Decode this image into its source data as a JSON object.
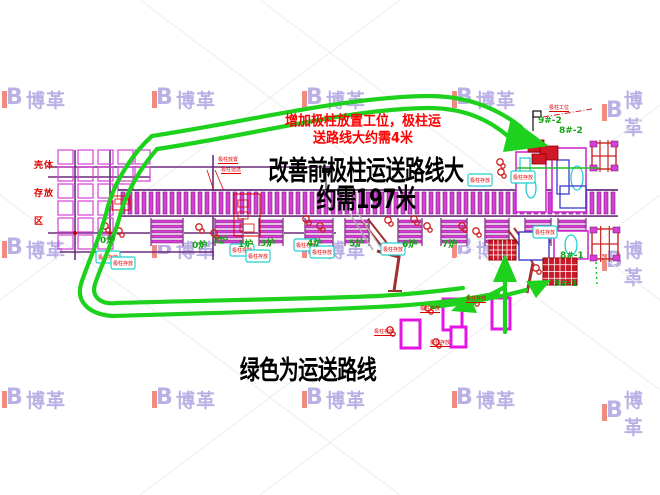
{
  "top_annotation": {
    "line1": "增加极柱放置工位，极柱运",
    "line2": "送路线大约需4米",
    "color": "#fe0000"
  },
  "title": {
    "line1": "改善前极柱运送路线大",
    "line2": "约需197米",
    "color": "#000000"
  },
  "bottom_note": "绿色为运送路线",
  "storage_area": {
    "lines": [
      "壳体",
      "存放",
      "区"
    ],
    "color": "#e00000"
  },
  "watermark": {
    "brand": "博革",
    "color": "#b5aae3",
    "accent": "#ef8276",
    "rows": 3,
    "cols": 5
  },
  "route": {
    "color": "#1dd11d",
    "meaning": "绿色为运送路线"
  },
  "furnace_labels": [
    {
      "text": "0炉",
      "x": 100,
      "y": 237
    },
    {
      "text": "0炉",
      "x": 192,
      "y": 242
    },
    {
      "text": "1炉",
      "x": 238,
      "y": 241
    },
    {
      "text": "2炉",
      "x": 213,
      "y": 237
    },
    {
      "text": "3炉",
      "x": 260,
      "y": 240
    },
    {
      "text": "4炉",
      "x": 307,
      "y": 240
    },
    {
      "text": "5炉",
      "x": 349,
      "y": 240
    },
    {
      "text": "6炉",
      "x": 402,
      "y": 241
    },
    {
      "text": "7炉",
      "x": 442,
      "y": 241
    }
  ],
  "machine_labels": [
    {
      "text": "9#-2",
      "x": 538,
      "y": 117
    },
    {
      "text": "8#-2",
      "x": 559,
      "y": 127
    },
    {
      "text": "8#-1",
      "x": 560,
      "y": 252
    },
    {
      "text": "9#-1",
      "x": 554,
      "y": 280
    }
  ],
  "micro_labels": [
    {
      "text": "极柱放置",
      "x": 218,
      "y": 158
    },
    {
      "text": "极柱运送",
      "x": 221,
      "y": 168
    },
    {
      "text": "极柱工位",
      "x": 549,
      "y": 106
    },
    {
      "text": "极柱存放",
      "x": 374,
      "y": 330
    },
    {
      "text": "极柱存放",
      "x": 420,
      "y": 307
    },
    {
      "text": "极柱存放",
      "x": 466,
      "y": 297
    },
    {
      "text": "极柱存放",
      "x": 430,
      "y": 341
    }
  ],
  "cyan_tag_text": "极柱存放",
  "colors": {
    "route_green": "#1dd11d",
    "label_green": "#15a315",
    "magenta": "#d63fd6",
    "pallet_magenta": "#e414e4",
    "purple_line": "#6b2d7b",
    "dark_red": "#a03030",
    "red": "#e00000",
    "crimson_block": "#c81a28",
    "cyan": "#25cfcf",
    "blue": "#3a3ac8"
  }
}
